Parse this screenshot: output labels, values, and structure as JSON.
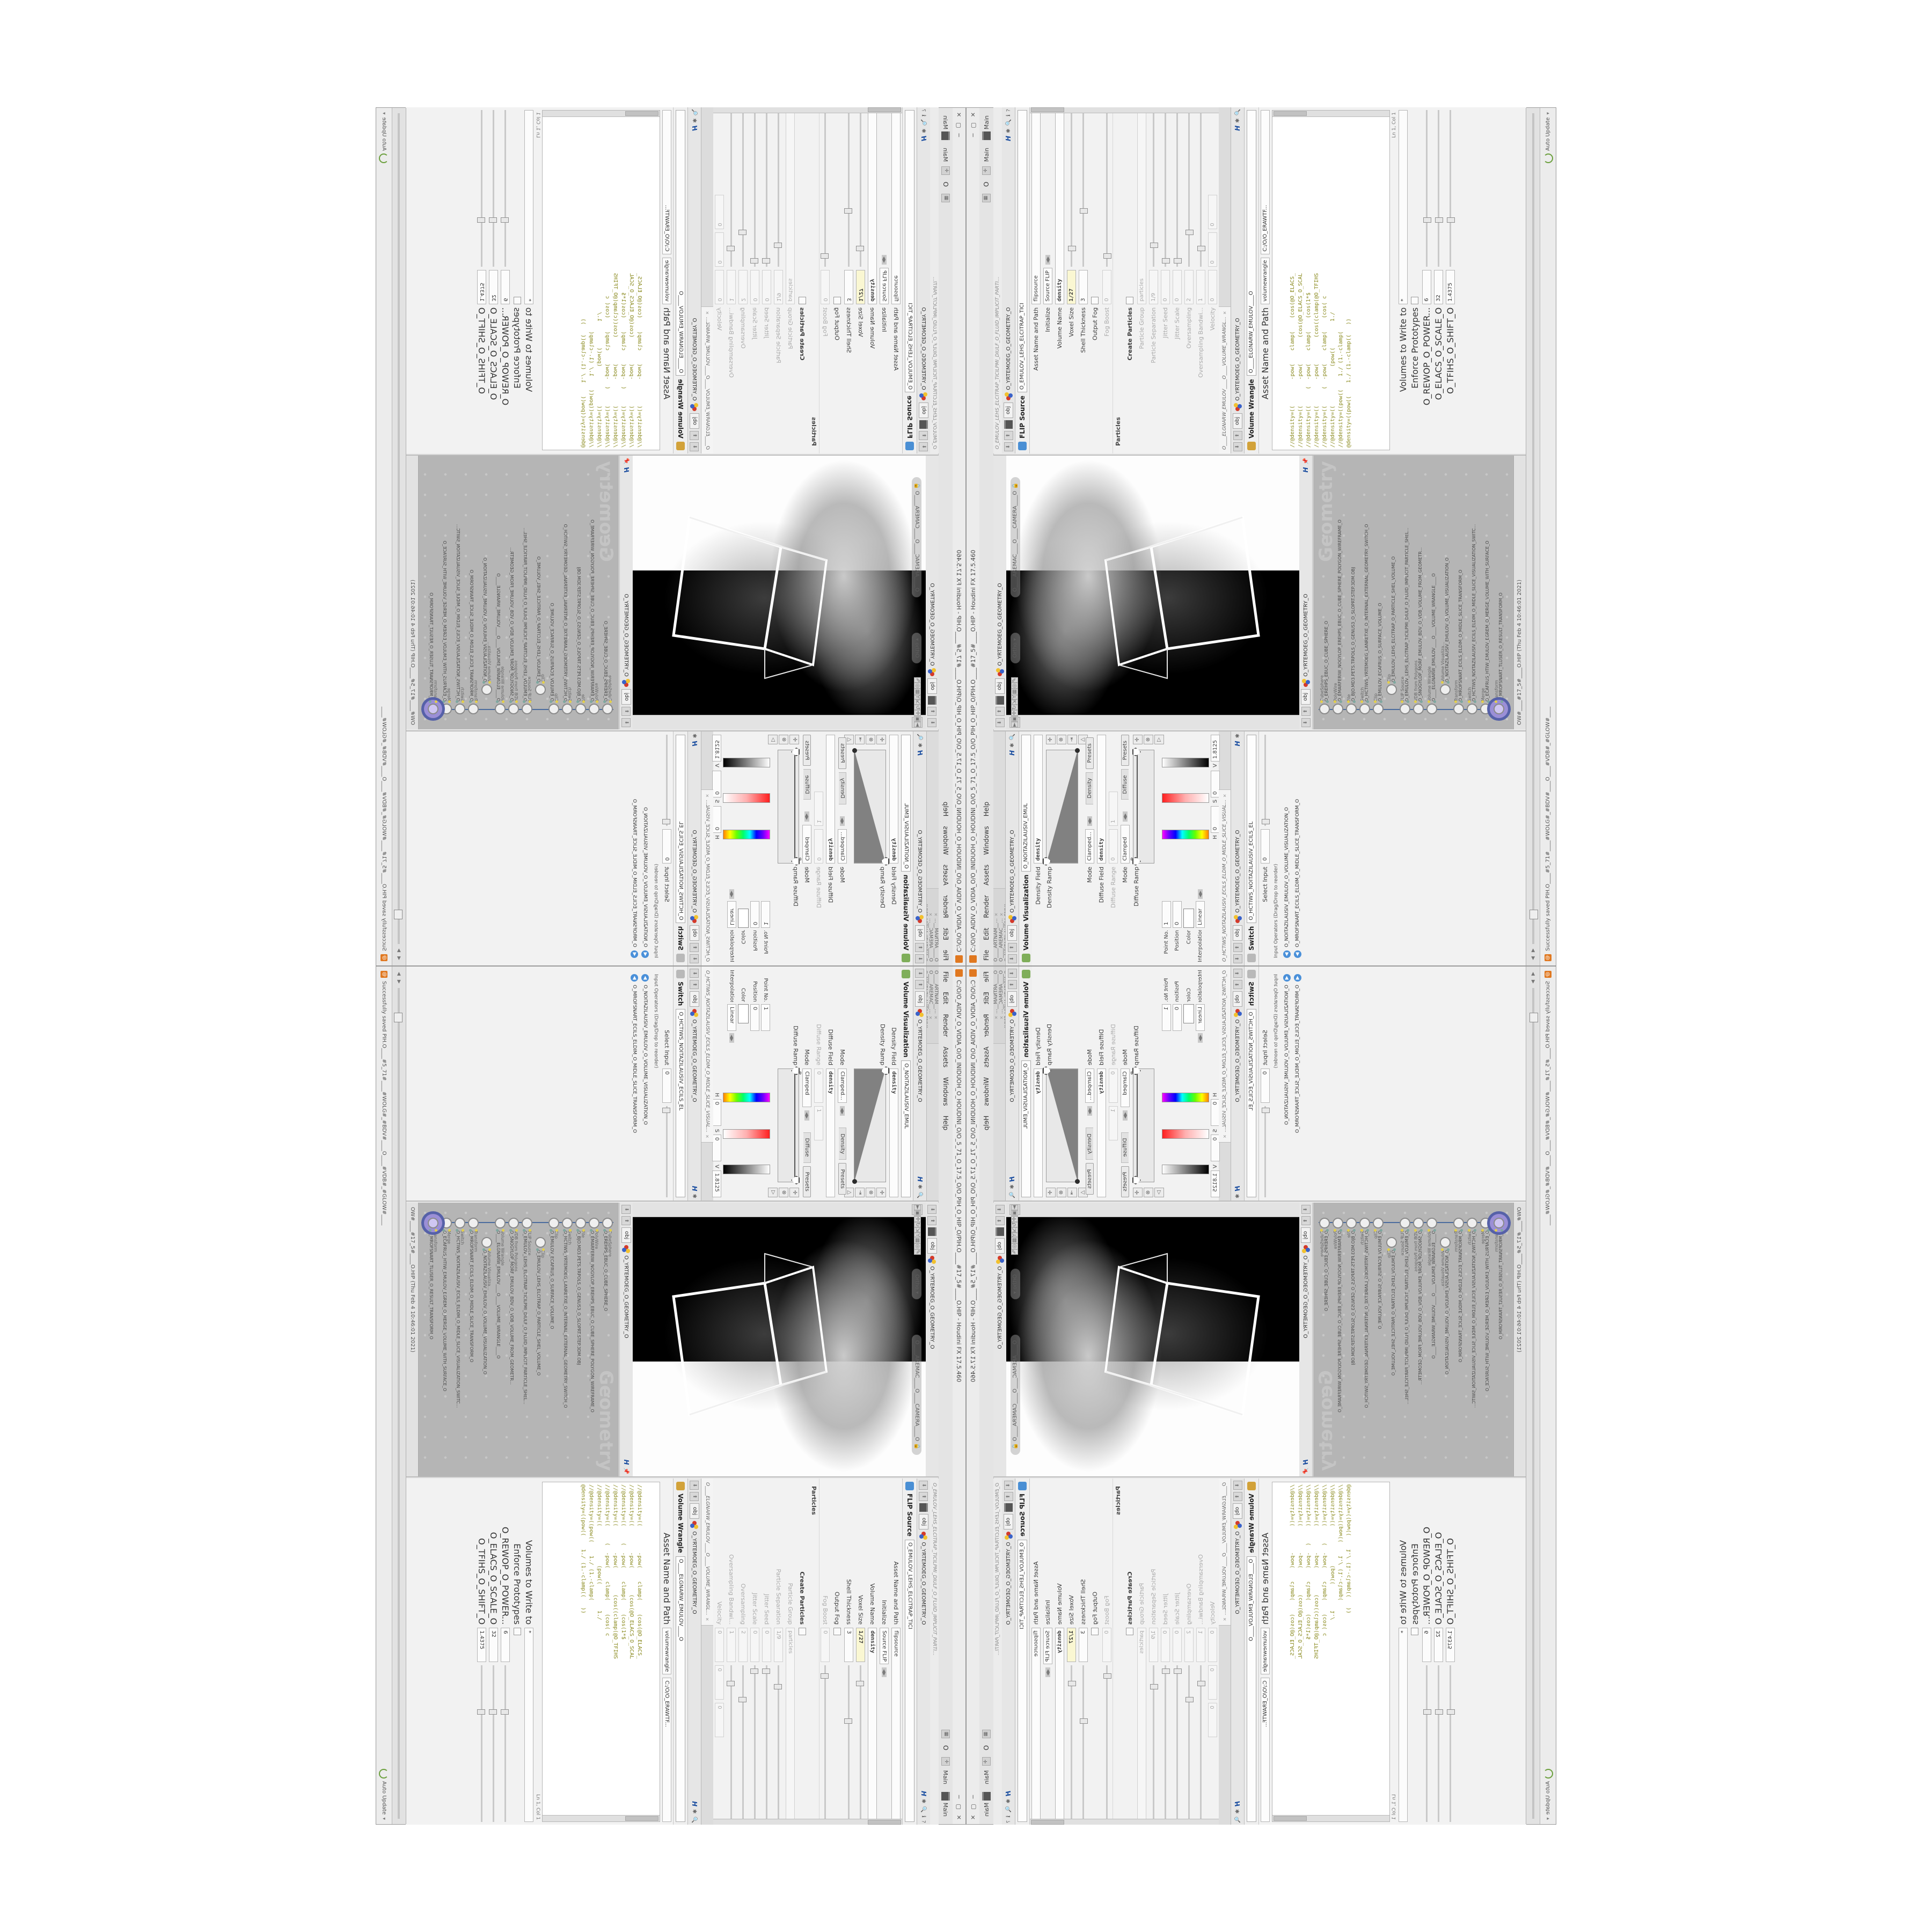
{
  "app": {
    "colors": {
      "accent_orange": "#e07820",
      "wire_blue": "#4a6b9e",
      "selected_purple": "#9b8fd6",
      "selected_ring": "#5661a8",
      "code_yellow": "#8a8a1e",
      "field_highlight": "#faf7d2",
      "network_grey": "#b5b5b5"
    }
  },
  "unit": {
    "titlebar": {
      "title": "C:/O/O_AIDIV_O_VIDIA_O/O_INIDUOH_O_HOUDINI_O/O_5_71_O_17.5_O/O_PIH_O_HIP_O/PIH.O____#17_5#____O.HIP - Houdini FX 17.5.460",
      "min": "─",
      "max": "▢",
      "close": "✕"
    },
    "menubar": {
      "items": [
        {
          "label": "File"
        },
        {
          "label": "Edit"
        },
        {
          "label": "Render"
        },
        {
          "label": "Assets"
        },
        {
          "label": "Windows"
        },
        {
          "label": "Help"
        }
      ],
      "o_label": "O",
      "desktop_label": "Main",
      "take_label": "Main"
    },
    "pathbar": {
      "obj": "obj",
      "path": "O_YRTEMOEG_O_GEOMETRY_O",
      "hlogo": "H"
    },
    "viz": {
      "tabs": [
        {
          "label": "O____ARTNAM__..."
        },
        {
          "label": "O____AREMAC__..."
        },
        {
          "label": "O_NOITAZILAUSIV_EMUL..."
        }
      ],
      "header": {
        "title": "Volume Visualization",
        "name": "O_NOITAZILAUSIV_EMUL"
      },
      "density": {
        "field_label": "Density Field",
        "field": "density",
        "ramp_label": "Density Ramp",
        "mode_label": "Mode",
        "mode": "Clamped...",
        "tab": "Density",
        "presets": "Presets"
      },
      "diffuse": {
        "field_label": "Diffuse Field",
        "field": "density",
        "range_label": "Diffuse Range",
        "range_min": "0",
        "range_max": "1",
        "mode_label": "Mode",
        "mode": "Clamped R...",
        "tab": "Diffuse",
        "presets": "Presets",
        "ramp_label": "Diffuse Ramp"
      },
      "point": {
        "no_label": "Point No.",
        "no": "1",
        "pos_label": "Position",
        "pos": "0",
        "color_label": "Color",
        "interp_label": "Interpolation",
        "interp": "Linear",
        "h_label": "H",
        "h": "0",
        "s_label": "S",
        "s": "0",
        "v_label": "V",
        "v": "1.8125"
      }
    },
    "switchpane": {
      "tab": "O_HCTIWS_NOITAZILAUSIV_ECILS_ELDIM_O_MIDLE_SLICE_VISUAL...",
      "header": {
        "title": "Switch",
        "name": "O_HCTIWS_NOITAZILAUSIV_ECILS_EL"
      },
      "select_label": "Select Input",
      "select": "0",
      "ops_label": "Input Operators (Drag/Drop to reorder)",
      "ops": [
        {
          "name": "O_NOITAZILAUSIV_EMULOV_O_VOLUME_VISUALIZATION_O"
        },
        {
          "name": "O_MROFSNART_ECILS_ELDIM_O_MIDLE_SLICE_TRANSFORM_O"
        }
      ]
    },
    "viewport": {
      "ortho": "Ortho ▾",
      "camera": "O____AREMAC____O____CAMERA____O 🔒",
      "tool_icons": [
        {
          "g": "►"
        },
        {
          "g": "▣"
        },
        {
          "g": "✛"
        },
        {
          "g": "↻"
        },
        {
          "g": "⇲"
        },
        {
          "g": "Y"
        },
        {
          "g": "▦"
        },
        {
          "g": "◎"
        },
        {
          "g": "✎"
        }
      ]
    },
    "network": {
      "watermark": "Geometry",
      "footer": "OW#____#17_5#____O.HIP (Thu Feb 4 10:46:01 2021)",
      "nodes": [
        {
          "type": "CubeSphere",
          "name": "O_EREHPS_EBUC_O_CUBE_SPHERE_O",
          "side": 0,
          "selected": 0
        },
        {
          "type": "PolyWire",
          "name": "O_EMARFERIW_NOGYLOP_EREHPS_EBUC_O_CUBE_SPHERE_POLYGON_WIREFRAME_O",
          "side": 0,
          "selected": 0
        },
        {
          "type": "File",
          "name": "O_BJO.MD3.PETS.TRPOLS_O_GENUS3_O_SLOPRT.STEP.3DM.OBJ",
          "side": 0,
          "selected": 0
        },
        {
          "type": "Switch",
          "name": "O_HCTIWS_YRTEMOEG_LANRETXE_O_INTERNAL_EXTERNAL_GEOMETRY_SWITCH_O",
          "side": 0,
          "selected": 0
        },
        {
          "type": "Clip",
          "name": "O_EMULOV_ECAFRUS_O_SURFACE_VOLUME_O",
          "side": 0,
          "selected": 0
        },
        {
          "type": "Clip",
          "name": "O_EMULOV_LEHS_ELCITRAP_O_PARTICLE_SHEL_VOLUME_O",
          "side": 1,
          "selected": 0
        },
        {
          "type": "FLIP Source",
          "name": "O_EMULOV_LEHS_ELCITRAP_TICILPMI_DIULF_O_FLUID_IMPLICIT_PARTICLE_SHEL...",
          "side": 0,
          "selected": 0
        },
        {
          "type": "VDB from Polygons",
          "name": "O_SNOGYLOP_MORF_EMULOV_BDV_O_VDB_VOLUME_FROM_GEOMETR...",
          "side": 0,
          "selected": 0
        },
        {
          "type": "Volume Wrangle",
          "name": "O____ELGNARW_EMULOV____O____VOLUME_WRANGLE____O",
          "side": 0,
          "selected": 0
        },
        {
          "type": "Volume Visualiza...",
          "name": "O_NOITAZILAUSIV_EMULOV_O_VOLUME_VISUALIZATION_O",
          "side": 1,
          "selected": 0
        },
        {
          "type": "Transform",
          "name": "O_MROFSNART_ECILS_ELDIM_O_MIDLE_SLICE_TRANSFORM_O",
          "side": 0,
          "selected": 0
        },
        {
          "type": "Switch",
          "name": "O_HCTIWS_NOITAZILAUSIV_ECILS_ELDIM_O_MIDLE_SLICE_VISUALIZATION_SWITC...",
          "side": 0,
          "selected": 0
        },
        {
          "type": "Merge",
          "name": "O_ECAFRUS_HTIW_EMULOV_EGREM_O_MERGE_VOLUME_WITH_SURFACE_O",
          "side": 0,
          "selected": 0
        },
        {
          "type": "Transform",
          "name": "O_MROFSNART_TLUSER_O_RESULT_TRANSFORM_O",
          "side": 0,
          "selected": 1
        }
      ]
    },
    "flip": {
      "hint": "O_EMULOV_LEHS_ELCITRAP_TICILPMI_DIULF_O_FLUID_IMPLICIT_PARTI...",
      "header": {
        "title": "FLIP Source",
        "name": "O_EMULOV_LEHS_ELCITRAP_TICI"
      },
      "asset_label": "Asset Name and Path",
      "asset": "flipsource",
      "init_label": "Initialize",
      "init": "Source FLIP",
      "volname_label": "Volume Name",
      "volname": "density",
      "voxel_label": "Voxel Size",
      "voxel": "1/27",
      "shell_label": "Shell Thickness",
      "shell": "3",
      "outputfog_label": "Output Fog",
      "fogboost_label": "Fog Boost",
      "fogboost": "0",
      "particles_section": "Particles",
      "create_label": "Create Particles",
      "pgroup_label": "Particle Group",
      "pgroup": "particles",
      "psep_label": "Particle Separation",
      "psep": "1/9",
      "jseed_label": "Jitter Seed",
      "jseed": "0",
      "jscale_label": "Jitter Scale",
      "jscale": "0",
      "oversamp_label": "Oversampling",
      "oversamp": "2",
      "oversampbw_label": "Oversampling Bandwi...",
      "oversampbw": "1",
      "velocity_label": "Velocity",
      "velocity": "0",
      "addrest_label": "Add Rest Attribute"
    },
    "wrangle": {
      "tab": "O____ELGNARW_EMULOV____O____VOLUME_WRANGL...",
      "header": {
        "title": "Volume Wrangle",
        "name": "O____ELGNARW_EMULOV____O"
      },
      "asset_label": "Asset Name and Path",
      "asset": "volumewrangle",
      "asset_path": "C:/O/O_ERAWTF...",
      "code": [
        {
          "t": "//@density=((        -pow(    clamp(    (cos(@O_ELACS_"
        },
        {
          "t": "//@density=((        -pow(        (cos(@O_ELACS_O_SCAL"
        },
        {
          "t": "//@density=((     (  -pow(    clamp(    (cos(1*$"
        },
        {
          "t": "//@density=((        -pow(        (cos((clamp(@O_TFIHS"
        },
        {
          "t": "//@density=((     (  -pow(    clamp(    (cos( c"
        },
        {
          "t": "//@density=((            (pow((        1./"
        },
        {
          "t": "//@density=((pow((    1./ (1.-clamp("
        },
        {
          "t": "@density=((pow((    1./ (1.-clamp((   ))"
        }
      ],
      "codefoot": "Ln 1, Col 1",
      "volumes_label": "Volumes to Write to",
      "volumes": "*",
      "enforce_label": "Enforce Prototypes",
      "sliders": [
        {
          "label": "O_REWOP_O_POWER...",
          "value": "6"
        },
        {
          "label": "O_ELACS_O_SCALE_O",
          "value": "32"
        },
        {
          "label": "O_TFIHS_O_SHIFT_O",
          "value": "1.4375"
        }
      ]
    },
    "footerbar": {
      "status": "Successfully saved PIH.O____#5_71#____#WOLG#_#BDV#____O____#VDB#_#GLOW#____",
      "auto_update": "Auto Update"
    }
  }
}
